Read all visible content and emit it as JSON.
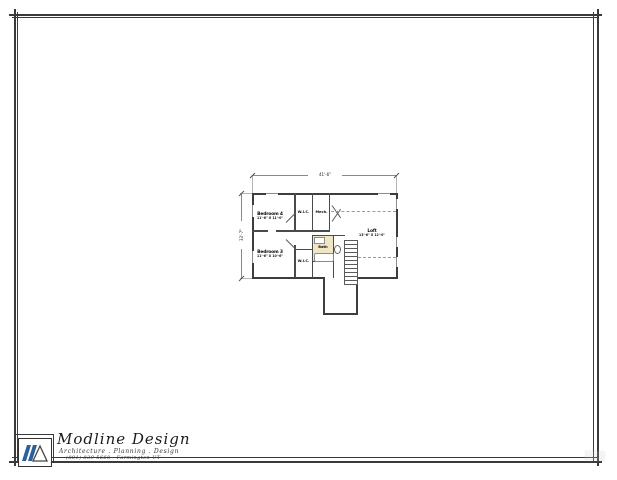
{
  "page": {
    "background": "#ffffff",
    "border_color": "#3a3a3a"
  },
  "title_block": {
    "company": "Modline Design",
    "tagline": "Architecture . Planning . Design",
    "contact": "(801) 839-5668 - Farmington UT",
    "logo_color": "#2e5f9c"
  },
  "corner_stamp": "░░░",
  "plan": {
    "overall_width": "41'-6\"",
    "overall_height": "33'-7\"",
    "bath_fill": "#f1e6c4",
    "rooms": {
      "bedroom4": {
        "name": "Bedroom 4",
        "size": "11'-6\" X 11'-0\""
      },
      "wic_top": {
        "name": "W.I.C."
      },
      "mech": {
        "name": "Mech."
      },
      "bath": {
        "name": "Bath"
      },
      "bedroom3": {
        "name": "Bedroom 3",
        "size": "11'-6\" X 10'-6\""
      },
      "wic_bottom": {
        "name": "W.I.C."
      },
      "loft": {
        "name": "Loft",
        "size": "13'-6\" X 12'-0\""
      }
    }
  }
}
